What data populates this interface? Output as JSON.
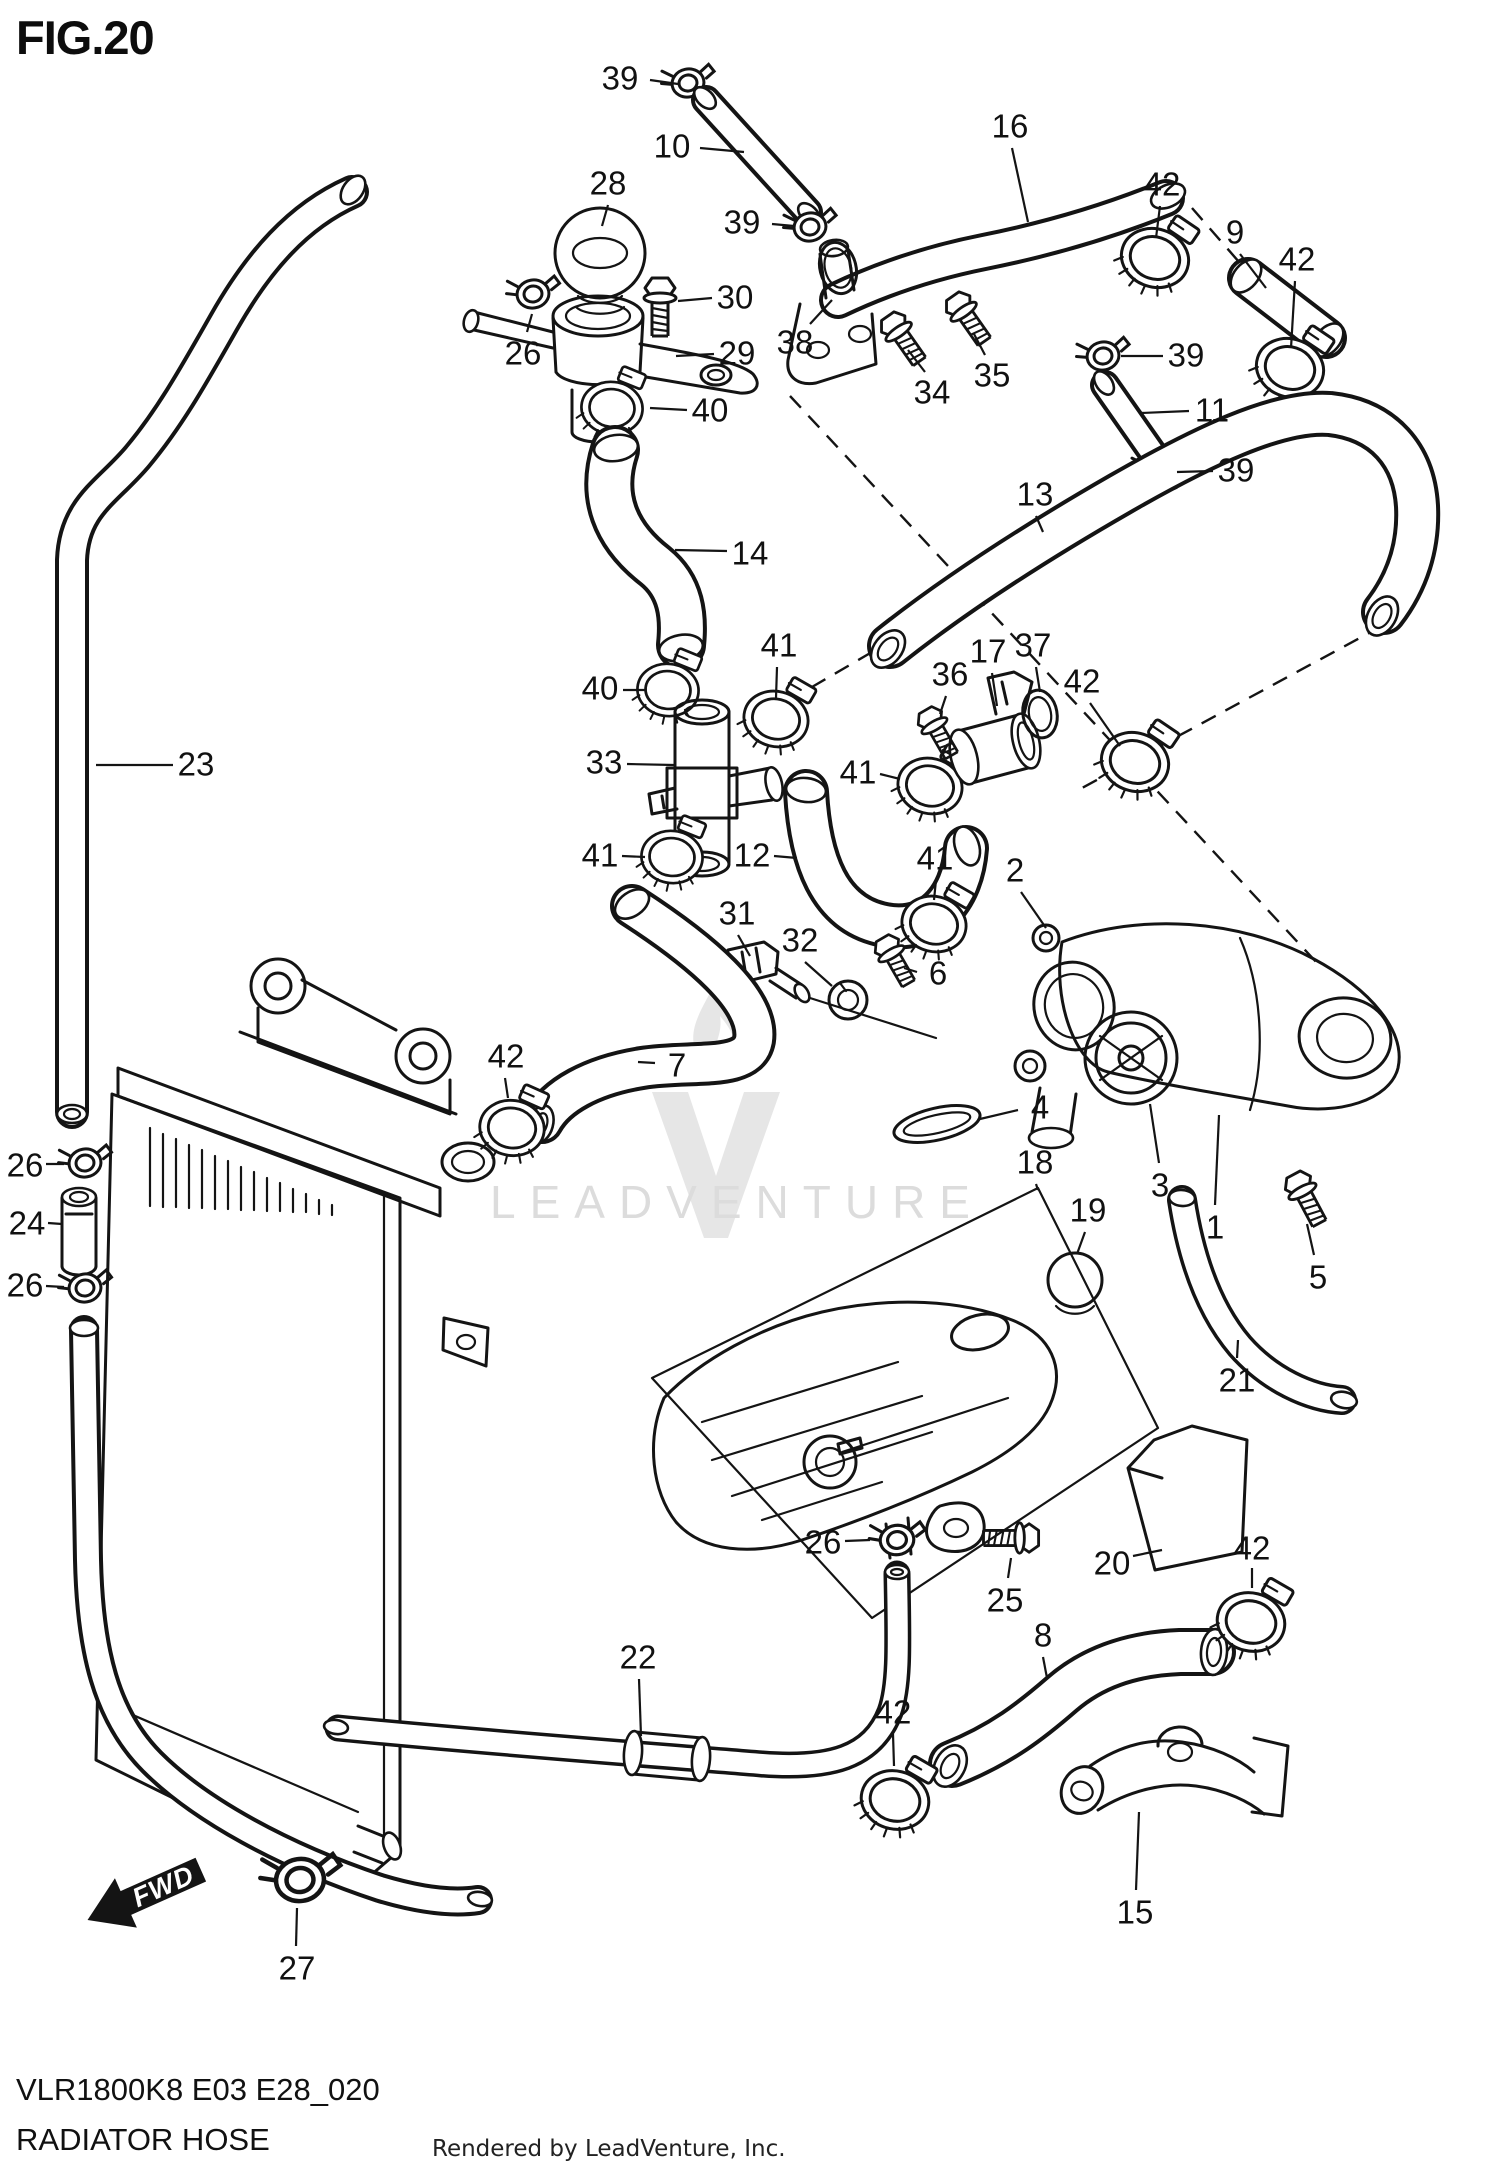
{
  "figure": {
    "title": "FIG.20",
    "code": "VLR1800K8 E03 E28_020",
    "name": "RADIATOR HOSE",
    "rendered_by": "Rendered by LeadVenture, Inc."
  },
  "watermark": {
    "text": "LEADVENTURE",
    "logo_icon": "leadventure-flame-v-icon"
  },
  "direction_indicator": {
    "label": "FWD"
  },
  "colors": {
    "line": "#141414",
    "label_text": "#111111",
    "background": "#ffffff",
    "watermark": "#dcdcdc"
  },
  "part_labels": [
    {
      "part": "39",
      "x": 620,
      "y": 78,
      "leader": [
        650,
        80,
        678,
        84
      ]
    },
    {
      "part": "10",
      "x": 672,
      "y": 146,
      "leader": [
        700,
        148,
        744,
        152
      ]
    },
    {
      "part": "16",
      "x": 1010,
      "y": 126,
      "leader": [
        1012,
        148,
        1028,
        222
      ]
    },
    {
      "part": "28",
      "x": 608,
      "y": 183,
      "leader": [
        608,
        205,
        602,
        226
      ]
    },
    {
      "part": "39",
      "x": 742,
      "y": 222,
      "leader": [
        772,
        224,
        794,
        226
      ]
    },
    {
      "part": "42",
      "x": 1162,
      "y": 184,
      "leader": [
        1160,
        206,
        1156,
        238
      ]
    },
    {
      "part": "9",
      "x": 1235,
      "y": 232,
      "leader": [
        1240,
        254,
        1266,
        288
      ]
    },
    {
      "part": "42",
      "x": 1297,
      "y": 259,
      "leader": [
        1295,
        281,
        1291,
        348
      ]
    },
    {
      "part": "30",
      "x": 735,
      "y": 297,
      "leader": [
        712,
        298,
        678,
        301
      ]
    },
    {
      "part": "26",
      "x": 523,
      "y": 353,
      "leader": [
        527,
        332,
        532,
        314
      ]
    },
    {
      "part": "29",
      "x": 737,
      "y": 353,
      "leader": [
        714,
        354,
        676,
        356
      ]
    },
    {
      "part": "38",
      "x": 795,
      "y": 342,
      "leader": [
        810,
        324,
        832,
        300
      ]
    },
    {
      "part": "34",
      "x": 932,
      "y": 392,
      "leader": [
        925,
        372,
        908,
        350
      ]
    },
    {
      "part": "35",
      "x": 992,
      "y": 375,
      "leader": [
        985,
        355,
        974,
        334
      ]
    },
    {
      "part": "39",
      "x": 1186,
      "y": 355,
      "leader": [
        1163,
        356,
        1121,
        356
      ]
    },
    {
      "part": "11",
      "x": 1212,
      "y": 410,
      "leader": [
        1189,
        411,
        1141,
        413
      ]
    },
    {
      "part": "39",
      "x": 1236,
      "y": 470,
      "leader": [
        1213,
        471,
        1177,
        472
      ]
    },
    {
      "part": "40",
      "x": 710,
      "y": 410,
      "leader": [
        687,
        410,
        650,
        408
      ]
    },
    {
      "part": "14",
      "x": 750,
      "y": 553,
      "leader": [
        727,
        551,
        675,
        550
      ]
    },
    {
      "part": "13",
      "x": 1035,
      "y": 494,
      "leader": [
        1036,
        516,
        1043,
        532
      ]
    },
    {
      "part": "23",
      "x": 196,
      "y": 764,
      "leader": [
        173,
        765,
        96,
        765
      ]
    },
    {
      "part": "40",
      "x": 600,
      "y": 688,
      "leader": [
        623,
        690,
        646,
        690
      ]
    },
    {
      "part": "41",
      "x": 779,
      "y": 645,
      "leader": [
        777,
        667,
        776,
        698
      ]
    },
    {
      "part": "36",
      "x": 950,
      "y": 674,
      "leader": [
        946,
        696,
        940,
        714
      ]
    },
    {
      "part": "17",
      "x": 988,
      "y": 651,
      "leader": [
        992,
        673,
        997,
        706
      ]
    },
    {
      "part": "37",
      "x": 1033,
      "y": 645,
      "leader": [
        1036,
        667,
        1040,
        692
      ]
    },
    {
      "part": "42",
      "x": 1082,
      "y": 681,
      "leader": [
        1090,
        703,
        1120,
        746
      ]
    },
    {
      "part": "33",
      "x": 604,
      "y": 762,
      "leader": [
        627,
        764,
        674,
        765
      ]
    },
    {
      "part": "41",
      "x": 858,
      "y": 772,
      "leader": [
        880,
        774,
        900,
        779
      ]
    },
    {
      "part": "12",
      "x": 752,
      "y": 855,
      "leader": [
        774,
        856,
        797,
        858
      ]
    },
    {
      "part": "41",
      "x": 600,
      "y": 855,
      "leader": [
        622,
        856,
        645,
        857
      ]
    },
    {
      "part": "41",
      "x": 935,
      "y": 858,
      "leader": [
        936,
        880,
        934,
        900
      ]
    },
    {
      "part": "31",
      "x": 737,
      "y": 913,
      "leader": [
        738,
        935,
        750,
        956
      ]
    },
    {
      "part": "32",
      "x": 800,
      "y": 940,
      "leader": [
        805,
        962,
        832,
        986
      ]
    },
    {
      "part": "6",
      "x": 938,
      "y": 973,
      "leader": [
        917,
        972,
        904,
        968
      ]
    },
    {
      "part": "2",
      "x": 1015,
      "y": 870,
      "leader": [
        1021,
        892,
        1046,
        928
      ]
    },
    {
      "part": "42",
      "x": 506,
      "y": 1056,
      "leader": [
        505,
        1078,
        508,
        1098
      ]
    },
    {
      "part": "7",
      "x": 677,
      "y": 1065,
      "leader": [
        655,
        1063,
        638,
        1062
      ]
    },
    {
      "part": "4",
      "x": 1040,
      "y": 1107,
      "leader": [
        1018,
        1110,
        980,
        1119
      ]
    },
    {
      "part": "18",
      "x": 1035,
      "y": 1162,
      "leader": [
        1036,
        1184,
        1038,
        1190
      ]
    },
    {
      "part": "19",
      "x": 1088,
      "y": 1210,
      "leader": [
        1085,
        1232,
        1077,
        1254
      ]
    },
    {
      "part": "3",
      "x": 1160,
      "y": 1185,
      "leader": [
        1159,
        1163,
        1150,
        1104
      ]
    },
    {
      "part": "1",
      "x": 1215,
      "y": 1227,
      "leader": [
        1215,
        1205,
        1219,
        1115
      ]
    },
    {
      "part": "5",
      "x": 1318,
      "y": 1277,
      "leader": [
        1314,
        1255,
        1307,
        1224
      ]
    },
    {
      "part": "21",
      "x": 1237,
      "y": 1380,
      "leader": [
        1237,
        1358,
        1238,
        1340
      ]
    },
    {
      "part": "26",
      "x": 25,
      "y": 1165,
      "leader": [
        46,
        1164,
        64,
        1164
      ]
    },
    {
      "part": "24",
      "x": 27,
      "y": 1223,
      "leader": [
        48,
        1223,
        62,
        1224
      ]
    },
    {
      "part": "26",
      "x": 25,
      "y": 1285,
      "leader": [
        46,
        1286,
        64,
        1287
      ]
    },
    {
      "part": "26",
      "x": 823,
      "y": 1542,
      "leader": [
        845,
        1541,
        870,
        1540
      ]
    },
    {
      "part": "25",
      "x": 1005,
      "y": 1600,
      "leader": [
        1008,
        1578,
        1011,
        1558
      ]
    },
    {
      "part": "22",
      "x": 638,
      "y": 1657,
      "leader": [
        639,
        1679,
        641,
        1736
      ]
    },
    {
      "part": "20",
      "x": 1112,
      "y": 1563,
      "leader": [
        1133,
        1556,
        1162,
        1550
      ]
    },
    {
      "part": "42",
      "x": 893,
      "y": 1712,
      "leader": [
        893,
        1734,
        894,
        1766
      ]
    },
    {
      "part": "8",
      "x": 1043,
      "y": 1635,
      "leader": [
        1043,
        1657,
        1047,
        1678
      ]
    },
    {
      "part": "42",
      "x": 1252,
      "y": 1548,
      "leader": [
        1252,
        1568,
        1252,
        1588
      ]
    },
    {
      "part": "15",
      "x": 1135,
      "y": 1912,
      "leader": [
        1136,
        1890,
        1139,
        1812
      ]
    },
    {
      "part": "27",
      "x": 297,
      "y": 1968,
      "leader": [
        296,
        1946,
        297,
        1908
      ]
    }
  ]
}
